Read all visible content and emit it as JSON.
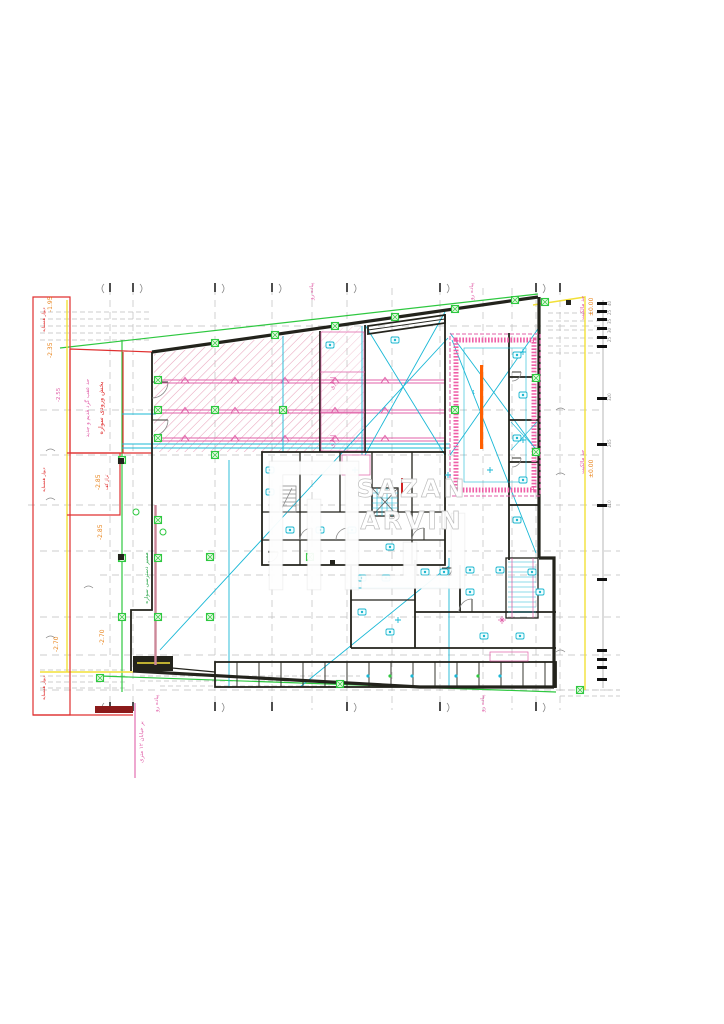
{
  "title": "basement-floor-plan-cad-drawing",
  "colors": {
    "wall": "#23231c",
    "green": "#2ec840",
    "yellow": "#f2e038",
    "pink": "#e060a8",
    "red": "#e03030",
    "orange": "#e8831a",
    "cyan": "#1ab8d6",
    "grid": "#bdbdbd",
    "orangebar": "#ff5f00"
  },
  "watermark": {
    "line1": "SAZAN",
    "line2": "ARVIN"
  },
  "labels": {
    "sidewalk": "پیاده رو",
    "street": "بر خیابان ۱۲ متری",
    "vehicle_access": "مسیر دسترسی سواره",
    "entry_section": "بخش ورودی سواره",
    "setback": "حد عقب گرد قدیم و جدید",
    "neighbor_wall": "دیوار همسایه",
    "property_limit": "حد مالکیت",
    "storage": "انباری",
    "floor_level": "تراز کف",
    "pool_mark": "1"
  },
  "elevations": {
    "top": "-1.95",
    "upper": "-2.35",
    "mid": "-2.55",
    "floor_a": "-2.85",
    "floor_b": "-2.85",
    "low_a": "-2.70",
    "low_b": "-2.70",
    "right_a": "±0.00",
    "right_b": "±0.00"
  },
  "dimensions": {
    "ticks": [
      "40",
      "25",
      "35",
      "30",
      "25",
      "320",
      "265",
      "410"
    ]
  }
}
